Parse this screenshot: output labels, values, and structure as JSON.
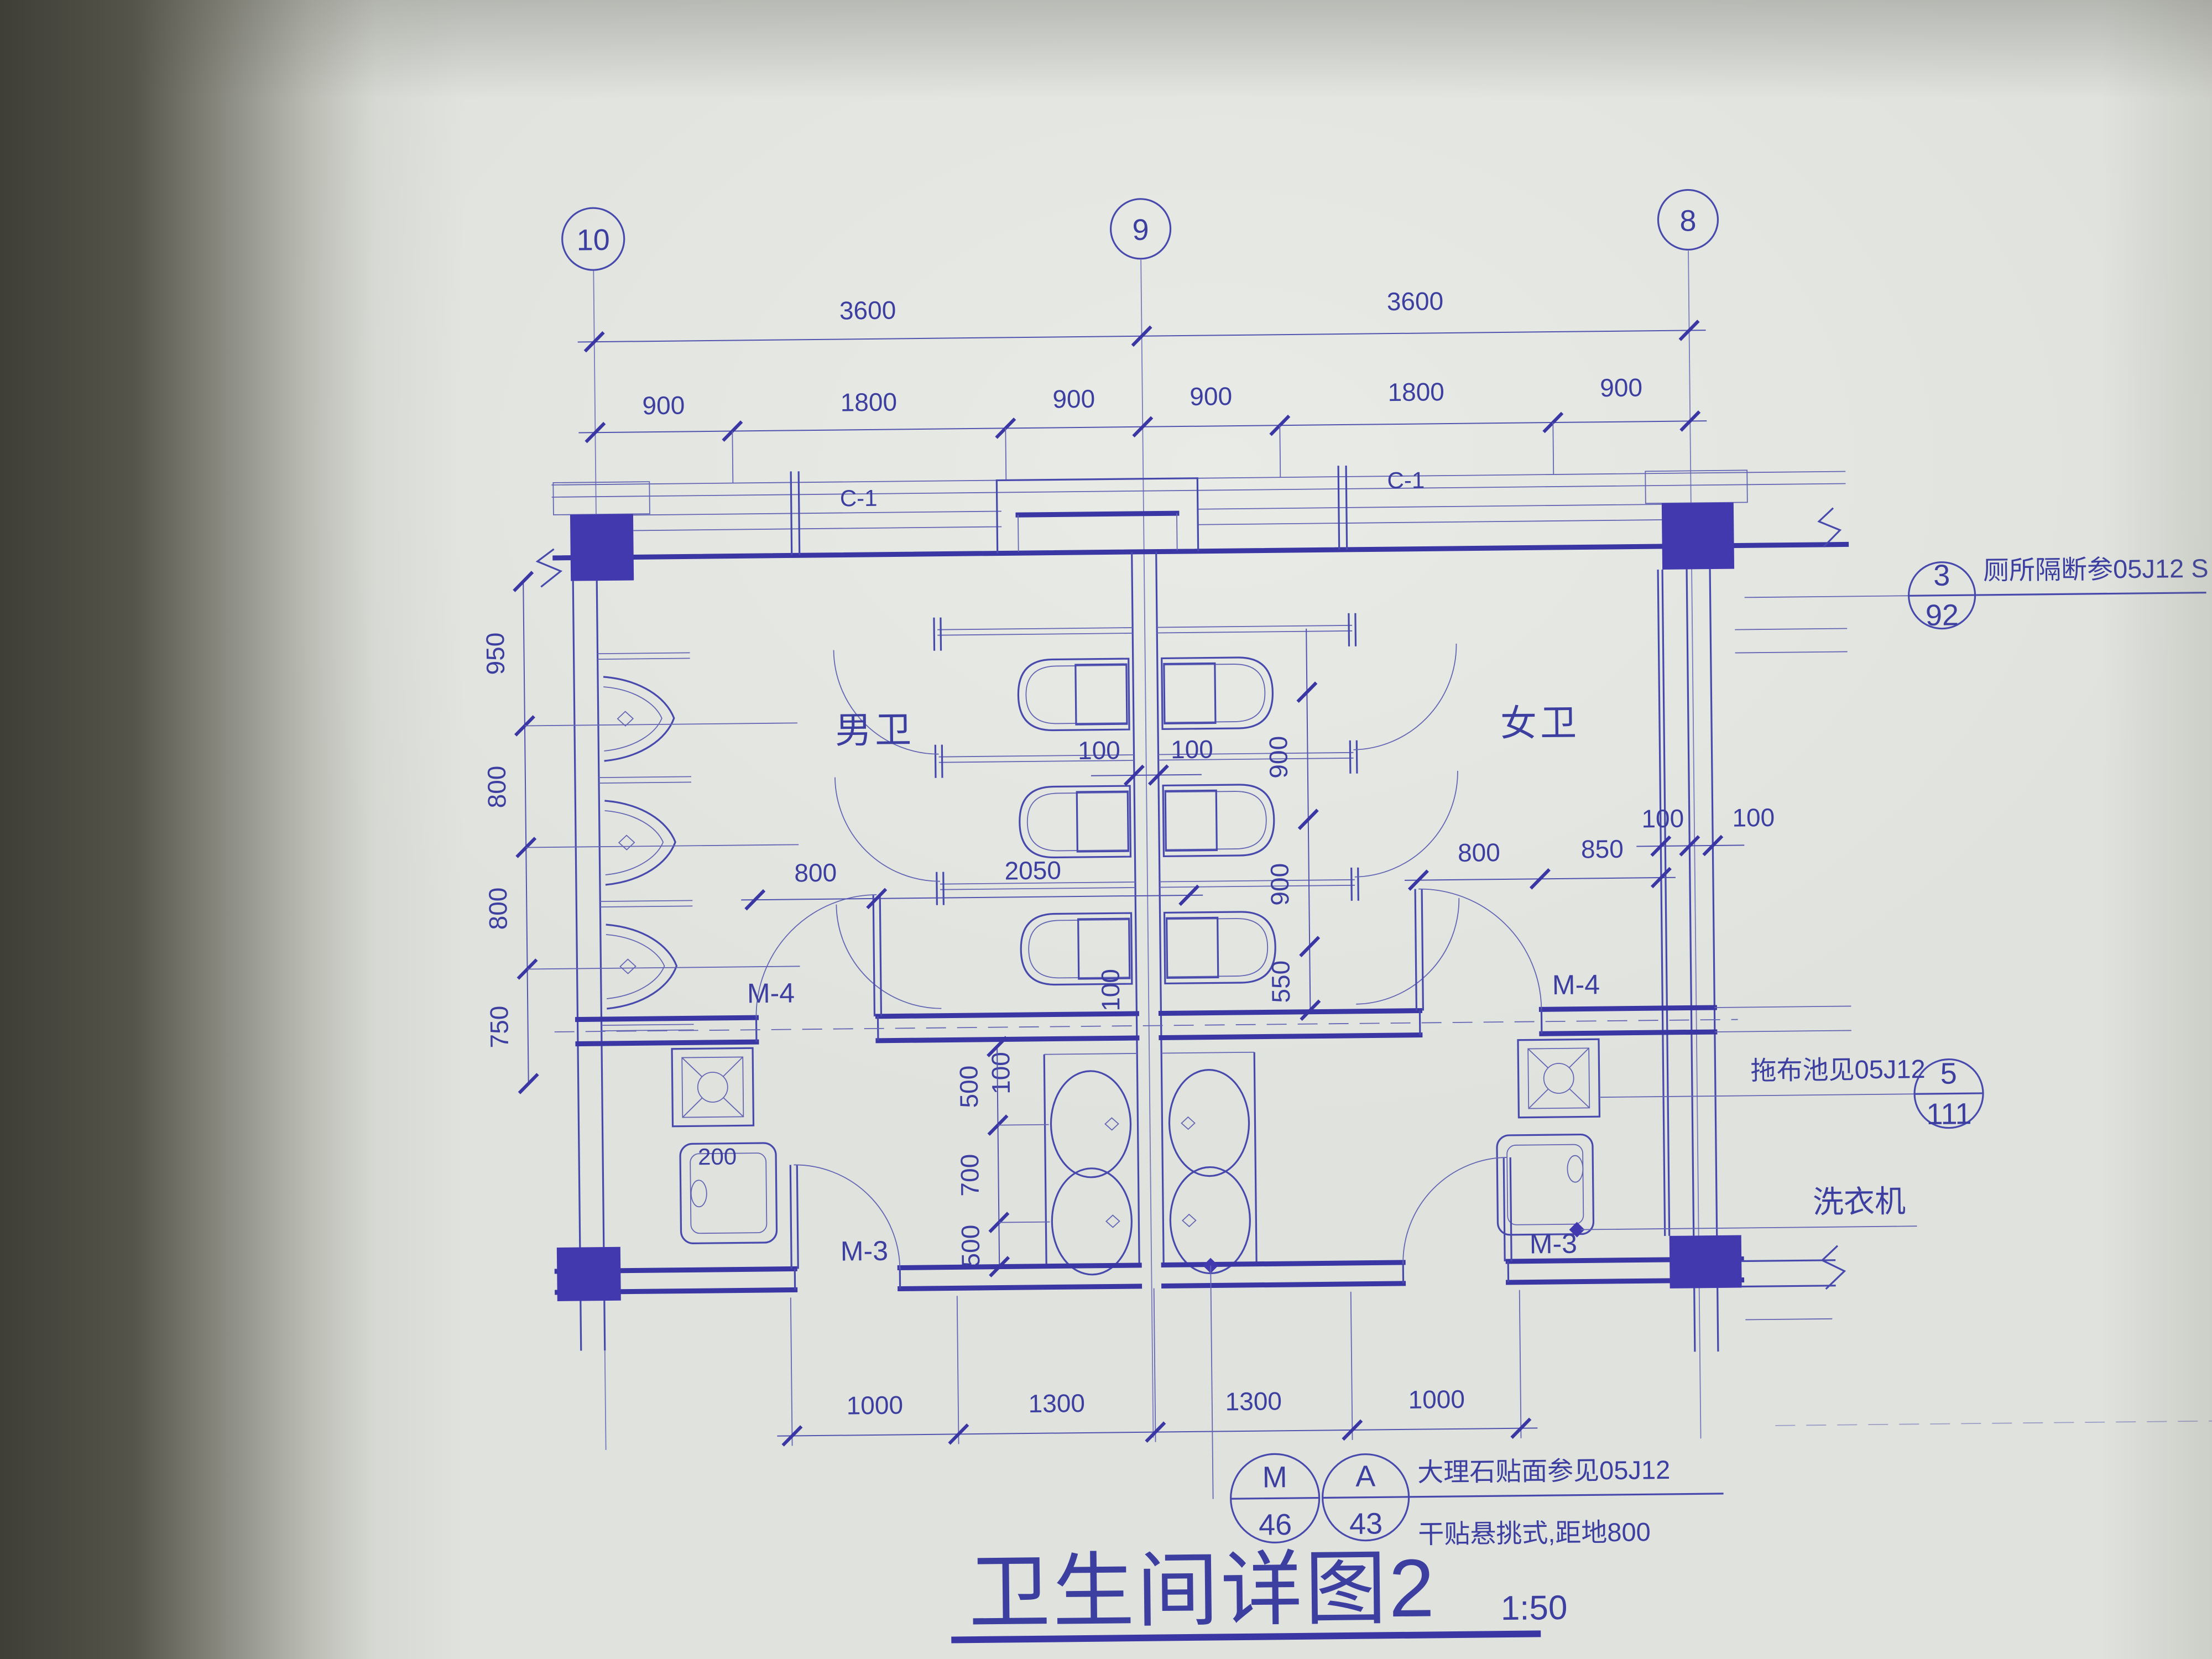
{
  "grid": {
    "bubbles": [
      "10",
      "9",
      "8"
    ]
  },
  "dims": {
    "top_spans": [
      "3600",
      "3600"
    ],
    "top_bays": [
      "900",
      "1800",
      "900",
      "900",
      "1800",
      "900"
    ],
    "left_vertical": [
      "950",
      "800",
      "800",
      "750"
    ],
    "stall_vertical": [
      "900",
      "900",
      "550"
    ],
    "central_wall": [
      "100",
      "100"
    ],
    "mid_left": [
      "800",
      "2050"
    ],
    "mid_right": [
      "800",
      "850"
    ],
    "east_wall": [
      "100",
      "100"
    ],
    "wall_v1": "100",
    "wall_v2": "100",
    "basin_vertical": [
      "500",
      "700",
      "500"
    ],
    "washer": "200",
    "bottom": [
      "1000",
      "1300",
      "1300",
      "1000"
    ]
  },
  "rooms": {
    "men": "男卫",
    "women": "女卫"
  },
  "windows": {
    "left": "C-1",
    "right": "C-1"
  },
  "doors": {
    "m4_left": "M-4",
    "m4_right": "M-4",
    "m3_left": "M-3",
    "m3_right": "M-3"
  },
  "annotations": {
    "partition": {
      "num": "3",
      "page": "92",
      "text": "厕所隔断参05J12 S"
    },
    "mop": {
      "num": "5",
      "page": "111",
      "text": "拖布池见05J12"
    },
    "washer_label": "洗衣机",
    "finish": {
      "c1num": "M",
      "c1page": "46",
      "c2num": "A",
      "c2page": "43",
      "line1": "大理石贴面参见05J12",
      "line2": "干贴悬挑式,距地800"
    }
  },
  "title": {
    "text": "卫生间详图2",
    "scale": "1:50"
  }
}
